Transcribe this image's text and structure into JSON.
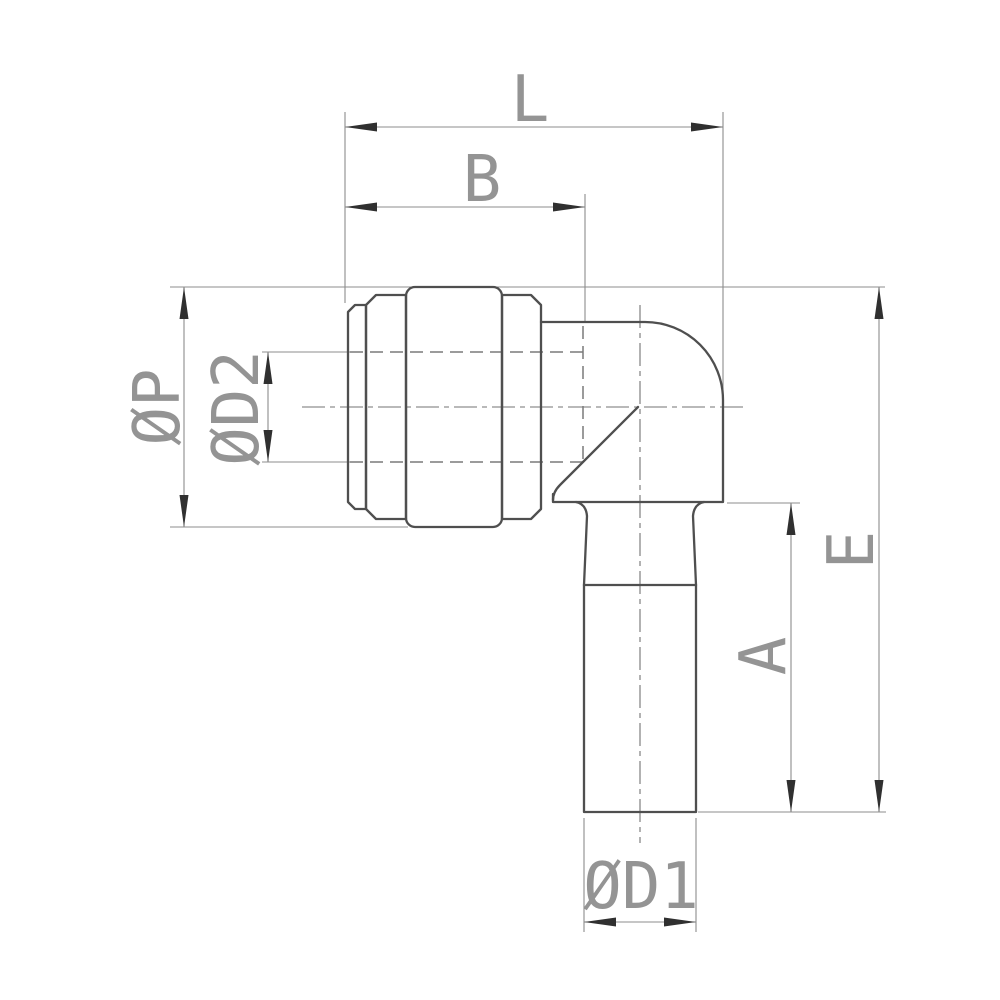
{
  "drawing": {
    "kind": "engineering-dimension-drawing",
    "view": "side-section-view-elbow-fitting",
    "labels": {
      "L": "L",
      "B": "B",
      "phi_P": "ØP",
      "phi_D2": "ØD2",
      "E": "E",
      "A": "A",
      "phi_D1": "ØD1"
    },
    "colors": {
      "background": "#ffffff",
      "object_line": "#4f4f4f",
      "hidden_line": "#7a7a7a",
      "center_line": "#737373",
      "dimension_line": "#8c8c8c",
      "arrowhead": "#303030",
      "label_text": "#949494"
    }
  }
}
